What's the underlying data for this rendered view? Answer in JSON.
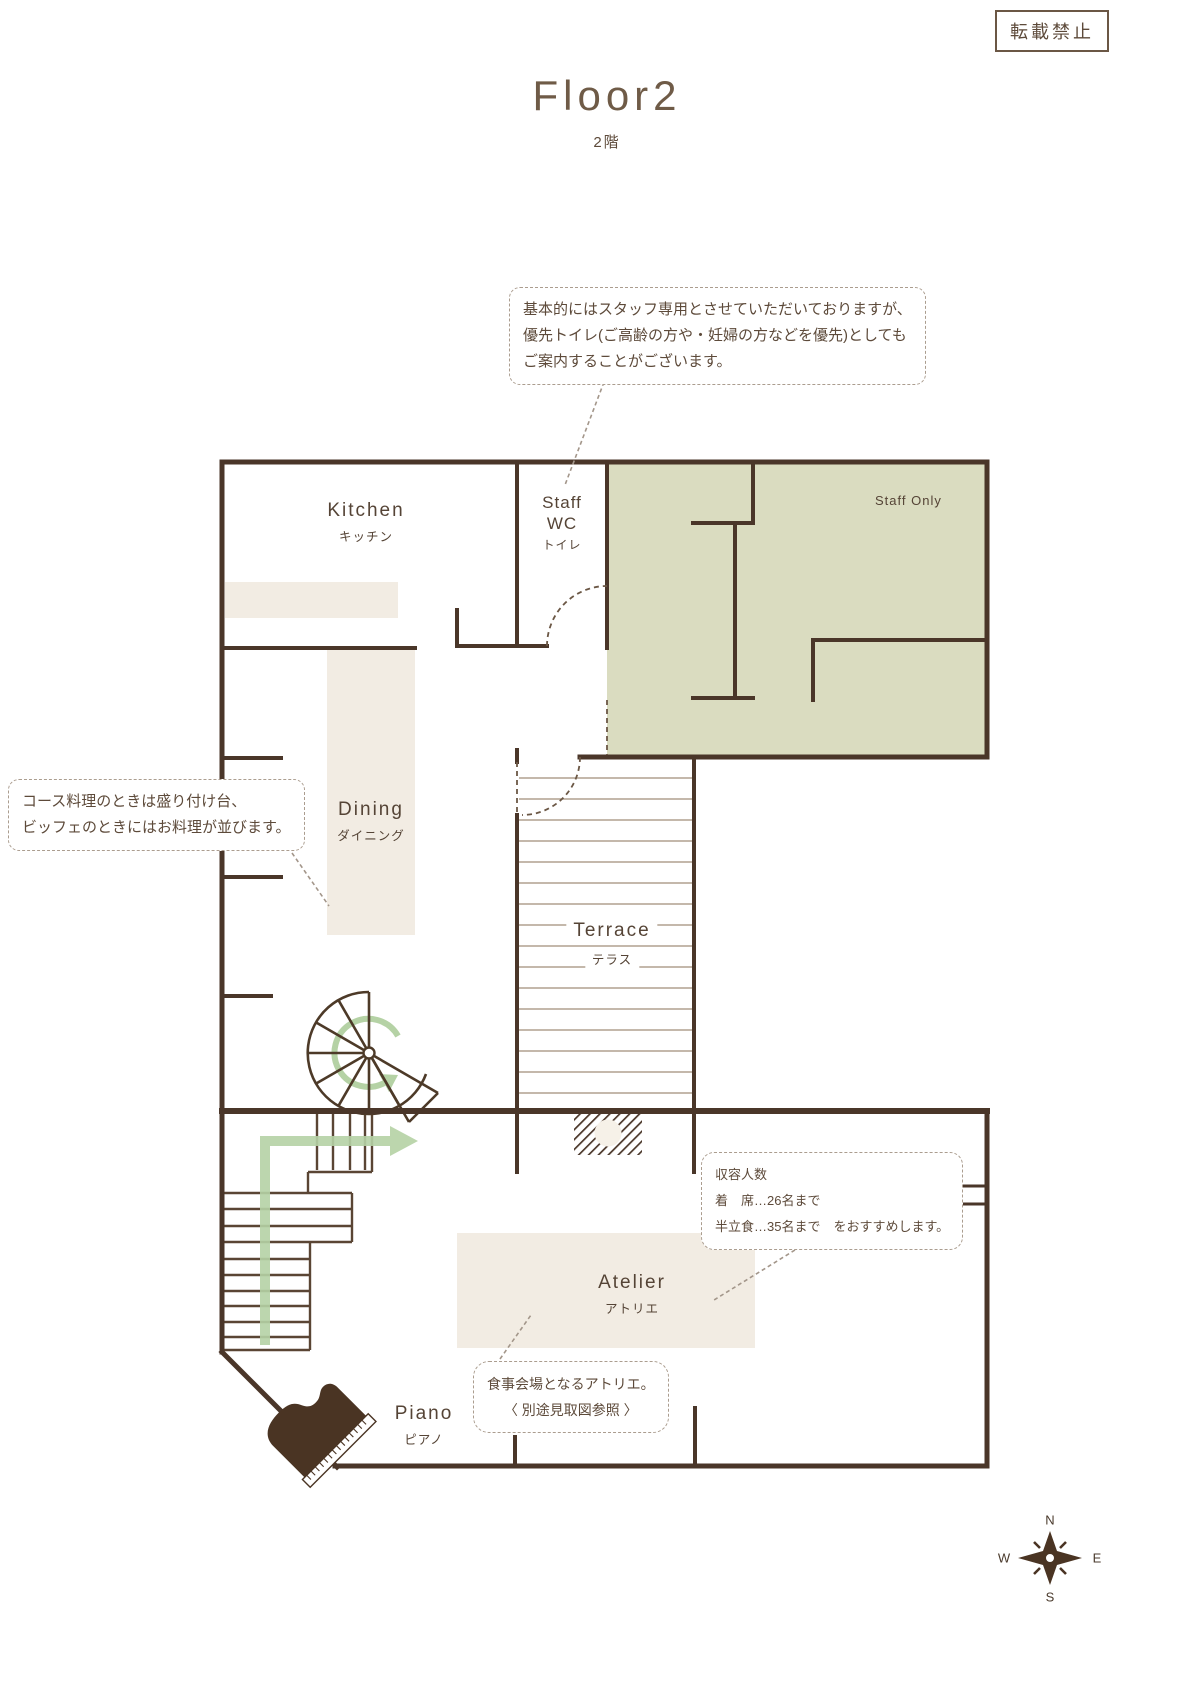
{
  "notice": "転載禁止",
  "title": {
    "en": "Floor2",
    "ja": "2階"
  },
  "rooms": {
    "kitchen": {
      "en": "Kitchen",
      "ja": "キッチン"
    },
    "staff_wc": {
      "line1": "Staff",
      "line2": "WC",
      "ja": "トイレ"
    },
    "staff_only": {
      "en": "Staff Only"
    },
    "dining": {
      "en": "Dining",
      "ja": "ダイニング"
    },
    "terrace": {
      "en": "Terrace",
      "ja": "テラス"
    },
    "atelier": {
      "en": "Atelier",
      "ja": "アトリエ"
    },
    "piano": {
      "en": "Piano",
      "ja": "ピアノ"
    }
  },
  "notes": {
    "wc": {
      "line1": "基本的にはスタッフ専用とさせていただいておりますが、",
      "line2": "優先トイレ(ご高齢の方や・妊婦の方などを優先)としても",
      "line3": "ご案内することがございます。"
    },
    "dining": {
      "line1": "コース料理のときは盛り付け台、",
      "line2": "ビッフェのときにはお料理が並びます。"
    },
    "capacity": {
      "line1": "収容人数",
      "line2": "着　席…26名まで",
      "line3": "半立食…35名まで　をおすすめします。"
    },
    "atelier": {
      "line1": "食事会場となるアトリエ。",
      "line2": "〈 別途見取図参照 〉"
    }
  },
  "compass": {
    "n": "N",
    "e": "E",
    "s": "S",
    "w": "W"
  },
  "colors": {
    "wall": "#4a3629",
    "staff_area": "#dadcc0",
    "furniture": "#f2ece3",
    "arrow": "#b5d2a5",
    "text": "#5d4a3a"
  }
}
